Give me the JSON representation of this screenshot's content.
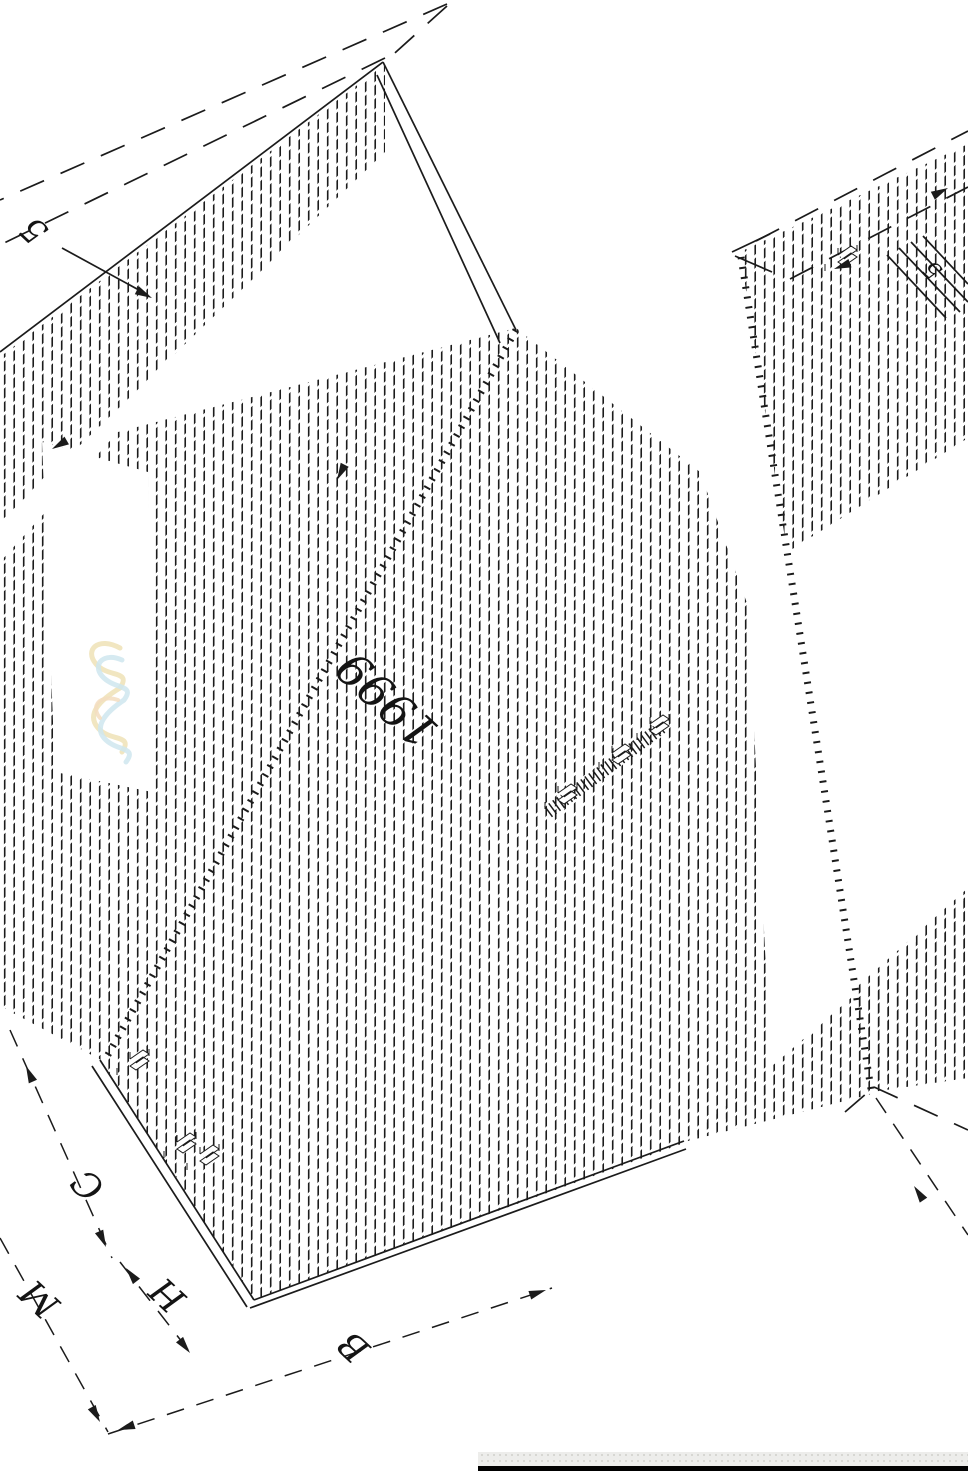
{
  "drawing": {
    "colors": {
      "ink": "#1b1b1b",
      "hatch": "#1c1c1c",
      "squiggle_yellow": "#efe2b6",
      "squiggle_cyan": "#cfe6ee",
      "squiggle_orange": "#f3ddc0",
      "bar_black": "#000000",
      "strip_bg": "#ededeb",
      "strip_dot": "#d7d7d3"
    },
    "labels": [
      {
        "name": "callout-5-left",
        "text": "5",
        "x": 42,
        "y": 222,
        "rot": -137,
        "size": 34
      },
      {
        "name": "part-number",
        "text": "1999",
        "x": 398,
        "y": 688,
        "rot": -137,
        "size": 46
      },
      {
        "name": "dim-label-c",
        "text": "C",
        "x": 96,
        "y": 1176,
        "rot": -137,
        "size": 36
      },
      {
        "name": "dim-label-m",
        "text": "M",
        "x": 48,
        "y": 1290,
        "rot": -137,
        "size": 36
      },
      {
        "name": "dim-label-h",
        "text": "H",
        "x": 176,
        "y": 1286,
        "rot": -137,
        "size": 36
      },
      {
        "name": "dim-label-b",
        "text": "B",
        "x": 362,
        "y": 1338,
        "rot": -137,
        "size": 36
      },
      {
        "name": "callout-5-right",
        "text": "5",
        "x": 938,
        "y": 264,
        "rot": -137,
        "size": 24
      }
    ],
    "hatch_regions": [
      {
        "name": "hatch-top-left-edge",
        "points": "385,64 0,357 0,522 385,152"
      },
      {
        "name": "hatch-main-swath",
        "points": "516,328 118,432 0,562 0,1006 101,1060 254,1300 684,1143 772,1092 748,606 700,472"
      },
      {
        "name": "hatch-right-panel",
        "points": "740,252 968,144 968,1078 872,1092"
      },
      {
        "name": "hatch-bottom-right-band",
        "points": "684,1142 968,897 968,1006 872,1094"
      }
    ],
    "white_overlays": [
      {
        "name": "white-pocket-squiggle",
        "points": "42,442 148,472 152,792 55,772"
      },
      {
        "name": "white-right-face",
        "points": "775,560 968,438 968,888 795,1042"
      }
    ],
    "phantom_dashed": [
      [
        447,
        4,
        0,
        200
      ],
      [
        385,
        58,
        0,
        245
      ],
      [
        447,
        6,
        387,
        60
      ],
      [
        756,
        241,
        968,
        131
      ],
      [
        790,
        279,
        968,
        187
      ],
      [
        874,
        1087,
        968,
        1130
      ],
      [
        845,
        1112,
        874,
        1087
      ]
    ],
    "dim_dashed": [
      [
        10,
        1030,
        112,
        1258
      ],
      [
        120,
        1262,
        196,
        1360
      ],
      [
        0,
        1238,
        108,
        1432
      ],
      [
        108,
        1434,
        552,
        1288
      ],
      [
        876,
        1098,
        968,
        1235
      ]
    ],
    "solid_lines": [
      [
        383,
        62,
        0,
        352
      ],
      [
        383,
        62,
        516,
        330
      ],
      [
        377,
        75,
        500,
        343
      ],
      [
        100,
        1060,
        254,
        1300
      ],
      [
        92,
        1066,
        247,
        1307
      ],
      [
        254,
        1300,
        684,
        1141
      ],
      [
        250,
        1308,
        686,
        1149
      ],
      [
        732,
        252,
        770,
        234
      ],
      [
        735,
        256,
        772,
        272
      ],
      [
        62,
        248,
        148,
        295
      ],
      [
        887,
        255,
        946,
        318
      ],
      [
        899,
        248,
        960,
        312
      ],
      [
        911,
        242,
        968,
        302
      ],
      [
        923,
        236,
        968,
        284
      ]
    ],
    "tick_lines": [
      {
        "name": "edge-ticks-left",
        "x1": 516,
        "y1": 330,
        "x2": 105,
        "y2": 1060,
        "w": 7,
        "dash": "2 8"
      },
      {
        "name": "edge-ticks-right",
        "x1": 741,
        "y1": 257,
        "x2": 871,
        "y2": 1089,
        "w": 7,
        "dash": "2 8"
      },
      {
        "name": "connector-rail",
        "x1": 548,
        "y1": 812,
        "x2": 662,
        "y2": 727,
        "w": 13,
        "dash": "1.5 3.5"
      }
    ],
    "arrows": [
      {
        "name": "leader-arrow-left",
        "x": 152,
        "y": 298,
        "a": 27
      },
      {
        "name": "edge-arrow",
        "x": 337,
        "y": 480,
        "a": 117
      },
      {
        "name": "dim-c-arrow-top",
        "x": 26,
        "y": 1066,
        "a": -114
      },
      {
        "name": "dim-c-arrow-bottom",
        "x": 106,
        "y": 1247,
        "a": 66
      },
      {
        "name": "dim-h-arrow-top",
        "x": 126,
        "y": 1268,
        "a": -128
      },
      {
        "name": "dim-h-arrow-bottom",
        "x": 190,
        "y": 1353,
        "a": 52
      },
      {
        "name": "dim-m-arrow",
        "x": 100,
        "y": 1422,
        "a": 61
      },
      {
        "name": "dim-b-arrow-start",
        "x": 118,
        "y": 1430,
        "a": 162
      },
      {
        "name": "dim-b-arrow-end",
        "x": 546,
        "y": 1290,
        "a": -18
      },
      {
        "name": "dim-right-arrow",
        "x": 914,
        "y": 1186,
        "a": -124
      },
      {
        "name": "callout-arrow-topright",
        "x": 948,
        "y": 188,
        "a": -27
      },
      {
        "name": "bar-arrow",
        "x": 834,
        "y": 269,
        "a": 160
      },
      {
        "name": "edge-arrow-left",
        "x": 52,
        "y": 449,
        "a": 150
      }
    ],
    "clips": [
      {
        "x": 130,
        "y": 1066
      },
      {
        "x": 177,
        "y": 1149
      },
      {
        "x": 200,
        "y": 1161
      },
      {
        "x": 558,
        "y": 800
      },
      {
        "x": 612,
        "y": 760
      },
      {
        "x": 650,
        "y": 731
      },
      {
        "x": 838,
        "y": 262
      }
    ],
    "squiggle_paths": [
      {
        "color_key": "squiggle_yellow",
        "w": 5,
        "d": "M120,648 C98,636 84,650 96,664 C108,678 132,670 120,688 C100,700 86,714 98,728 C110,742 134,734 122,752"
      },
      {
        "color_key": "squiggle_cyan",
        "w": 5,
        "d": "M122,660 C104,652 92,664 102,676 C114,690 136,684 124,700 C106,712 94,726 104,738 C116,752 138,746 126,762"
      },
      {
        "color_key": "squiggle_orange",
        "w": 4,
        "d": "M118,700 C100,694 90,706 100,718"
      }
    ],
    "bottom_bar": {
      "x": 478,
      "y": 1466,
      "w": 490,
      "h": 5,
      "strip_y": 1452,
      "strip_h": 14
    }
  }
}
